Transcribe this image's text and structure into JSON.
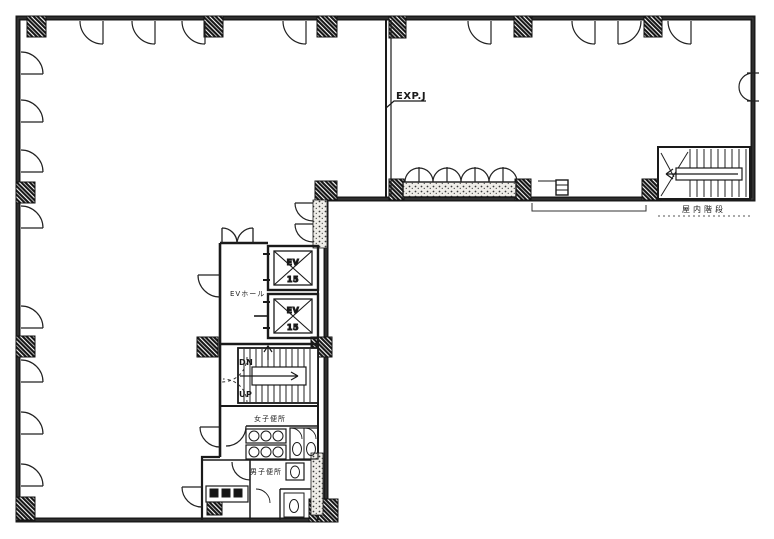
{
  "page": {
    "background": "#ffffff",
    "ink": "#1a1a1a",
    "description_labels_language": "ja"
  },
  "plan": {
    "expansion_joint_label": "EXP.J",
    "elevator_hall_label": "EVホール",
    "stair_down_label": "DN",
    "stair_up_label": "UP",
    "womens_toilet_label": "女子便所",
    "mens_toilet_label": "男子便所",
    "indoor_stair_label": "屋内階段",
    "elevators": [
      {
        "label": "EV",
        "capacity": "15"
      },
      {
        "label": "EV",
        "capacity": "15"
      }
    ]
  }
}
